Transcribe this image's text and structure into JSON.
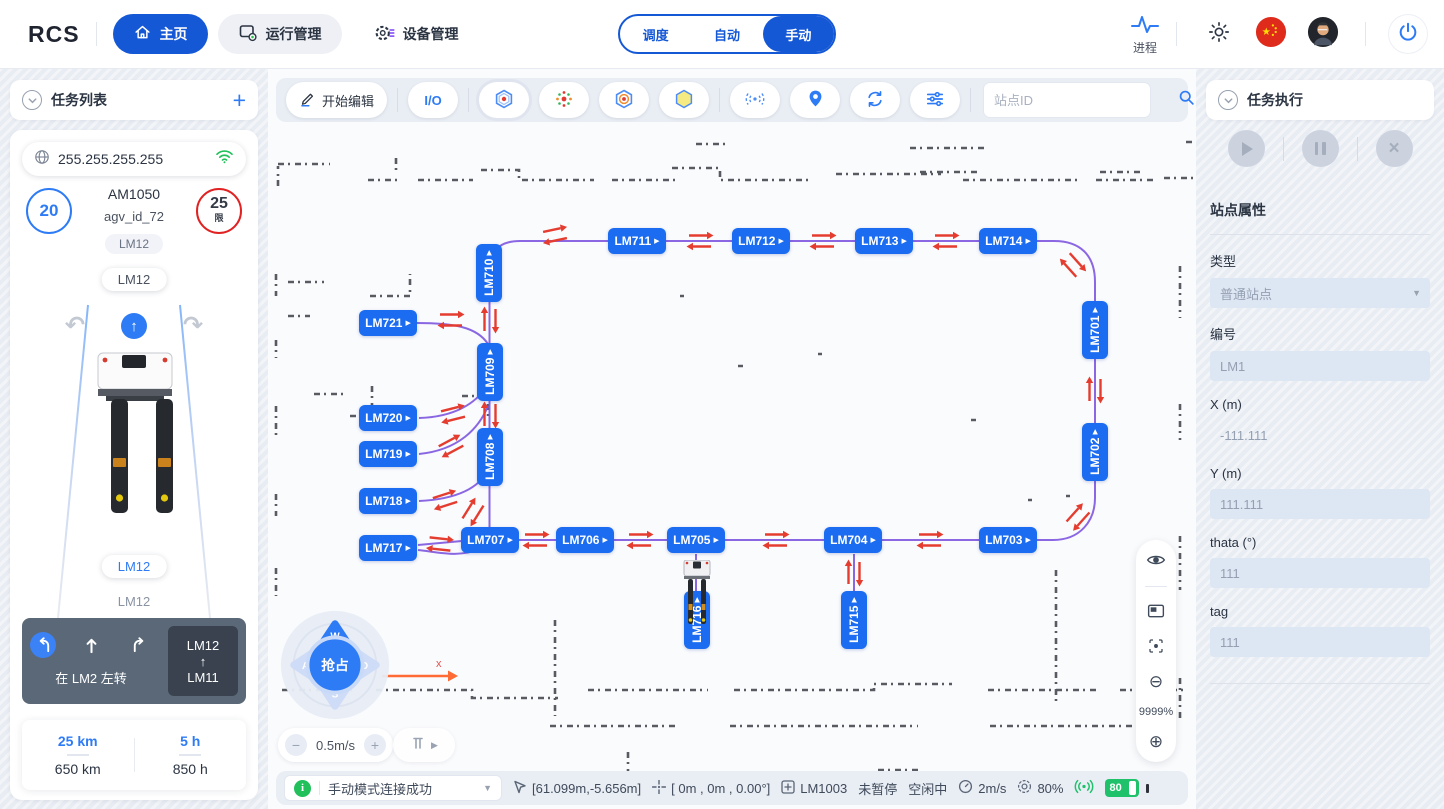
{
  "topbar": {
    "logo": "RCS",
    "nav": [
      {
        "label": "主页"
      },
      {
        "label": "运行管理"
      },
      {
        "label": "设备管理"
      }
    ],
    "tabs": [
      {
        "label": "调度"
      },
      {
        "label": "自动"
      },
      {
        "label": "手动"
      }
    ],
    "process_label": "进程"
  },
  "icons": {
    "play": "▶",
    "close": "×",
    "plus": "+",
    "minus": "−",
    "caret_down": "▼",
    "zoom_in": "⊕",
    "zoom_out": "⊖",
    "curve_left": "↶",
    "curve_right": "↷",
    "arrow_up": "↑"
  },
  "left": {
    "header": "任务列表",
    "ip": "255.255.255.255",
    "speed_value": "20",
    "speed_limit": "25",
    "speed_limit_tag": "限",
    "model": "AM1050",
    "agv_id": "agv_id_72",
    "pills": [
      "LM12",
      "LM12",
      "LM12",
      "LM12"
    ],
    "nav_hint": "在 LM2 左转",
    "route": {
      "from": "LM12",
      "arrow": "↑",
      "to": "LM11"
    },
    "stats": [
      {
        "value": "25 km",
        "total": "650 km"
      },
      {
        "value": "5 h",
        "total": "850 h"
      }
    ]
  },
  "toolbar": {
    "edit": "开始编辑",
    "io": "I/O",
    "search_placeholder": "站点ID"
  },
  "map": {
    "zoom": "9999%",
    "speed": "0.5m/s",
    "joystick": {
      "up": "W",
      "left": "A",
      "down": "S",
      "right": "D",
      "center": "抢占",
      "axis": "x"
    },
    "stations": [
      {
        "id": "LM710",
        "x": 221,
        "y": 205,
        "v": true
      },
      {
        "id": "LM711",
        "x": 369,
        "y": 173
      },
      {
        "id": "LM712",
        "x": 493,
        "y": 173
      },
      {
        "id": "LM713",
        "x": 616,
        "y": 173
      },
      {
        "id": "LM714",
        "x": 740,
        "y": 173
      },
      {
        "id": "LM701",
        "x": 827,
        "y": 262,
        "v": true
      },
      {
        "id": "LM702",
        "x": 827,
        "y": 384,
        "v": true
      },
      {
        "id": "LM703",
        "x": 740,
        "y": 472
      },
      {
        "id": "LM704",
        "x": 585,
        "y": 472
      },
      {
        "id": "LM705",
        "x": 428,
        "y": 472
      },
      {
        "id": "LM706",
        "x": 317,
        "y": 472
      },
      {
        "id": "LM707",
        "x": 222,
        "y": 472
      },
      {
        "id": "LM708",
        "x": 222,
        "y": 389,
        "v": true
      },
      {
        "id": "LM709",
        "x": 222,
        "y": 304,
        "v": true
      },
      {
        "id": "LM715",
        "x": 586,
        "y": 552,
        "v": true
      },
      {
        "id": "LM716",
        "x": 429,
        "y": 552,
        "v": true
      },
      {
        "id": "LM717",
        "x": 120,
        "y": 480
      },
      {
        "id": "LM718",
        "x": 120,
        "y": 433
      },
      {
        "id": "LM719",
        "x": 120,
        "y": 386
      },
      {
        "id": "LM720",
        "x": 120,
        "y": 350
      },
      {
        "id": "LM721",
        "x": 120,
        "y": 255
      }
    ],
    "arrows": [
      [
        287,
        167,
        -12
      ],
      [
        432,
        173,
        0
      ],
      [
        555,
        173,
        0
      ],
      [
        678,
        173,
        0
      ],
      [
        805,
        197,
        48
      ],
      [
        827,
        322,
        -90
      ],
      [
        810,
        449,
        132
      ],
      [
        662,
        472,
        0
      ],
      [
        508,
        472,
        0
      ],
      [
        372,
        472,
        0
      ],
      [
        268,
        472,
        0
      ],
      [
        172,
        476,
        6
      ],
      [
        183,
        252,
        0
      ],
      [
        185,
        346,
        -14
      ],
      [
        183,
        378,
        -28
      ],
      [
        177,
        432,
        -18
      ],
      [
        205,
        444,
        -58
      ],
      [
        222,
        252,
        -90
      ],
      [
        222,
        347,
        -90
      ],
      [
        586,
        505,
        -90
      ]
    ]
  },
  "statusbar": {
    "message": "手动模式连接成功",
    "coords": "[61.099m,-5.656m]",
    "pose": "[ 0m , 0m , 0.00°]",
    "station": "LM1003",
    "pause": "未暂停",
    "state": "空闲中",
    "speed": "2m/s",
    "percent": "80%",
    "battery": "80"
  },
  "right": {
    "header": "任务执行",
    "props_title": "站点属性",
    "fields": [
      {
        "label": "类型",
        "value": "普通站点"
      },
      {
        "label": "编号",
        "value": "LM1"
      },
      {
        "label": "X (m)",
        "value": "-111.111"
      },
      {
        "label": "Y (m)",
        "value": "111.111"
      },
      {
        "label": "thata (°)",
        "value": "111"
      },
      {
        "label": "tag",
        "value": "111"
      }
    ]
  }
}
